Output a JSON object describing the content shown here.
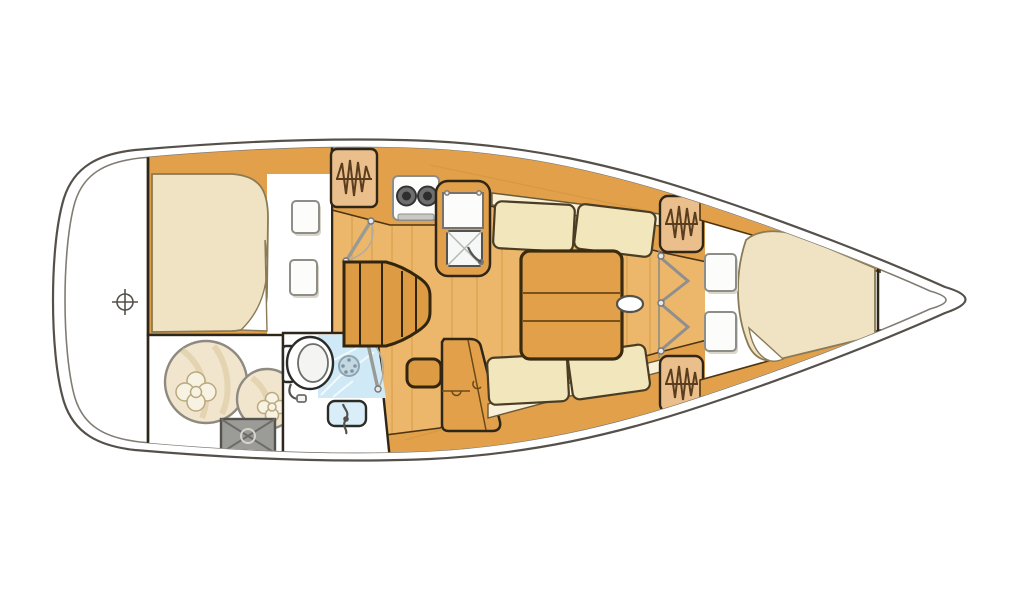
{
  "diagram": {
    "kind": "yacht-interior-floor-plan",
    "orientation": "bow-pointing-right",
    "areas": [
      "stern-platform",
      "aft-double-cabin",
      "sail-storage-locker",
      "head-with-shower",
      "galley",
      "companionway-steps",
      "salon-with-settees-and-table",
      "nav-seat",
      "forward-v-berth-cabin",
      "anchor-locker"
    ],
    "fixture_icons": [
      "rudder-post-crosshair-icon",
      "sail-bag-icon",
      "deck-hatch-icon",
      "toilet-icon",
      "shower-drain-icon",
      "washbasin-faucet-icon",
      "two-burner-stove-icon",
      "galley-sink-icon",
      "icebox-icon",
      "hanging-locker-hanger-icon",
      "door-swing-icon",
      "folding-door-icon",
      "mast-post-icon",
      "pillow-icon"
    ],
    "counts": {
      "pillows": 4,
      "hanging_lockers": 3,
      "settee_cushions": 4,
      "sail_bags": 2
    }
  },
  "colors": {
    "hullLine": "#55504a",
    "innerLine": "#817c74",
    "roomBorder": "#2e2619",
    "wood": "#e2a04a",
    "woodFloor": "#ecb76a",
    "woodEdge": "#4d3511",
    "plankLine": "#cf953f",
    "stepWood": "#dd9c44",
    "cushion": "#f2e6bd",
    "cushionLight": "#f8f1d8",
    "mattress": "#efe3c3",
    "mattressEdge": "#8a7a55",
    "pillow": "#fcfcfb",
    "pillowEdge": "#8e8e88",
    "lockerTan": "#eabf8c",
    "hanger": "#5a3c1e",
    "showerBlue": "#cfe9f6",
    "sinkBlue": "#d9eef8",
    "metalGray": "#9b9b97",
    "bag": "#f1e6cd",
    "bagDetail": "#d9c49b"
  }
}
